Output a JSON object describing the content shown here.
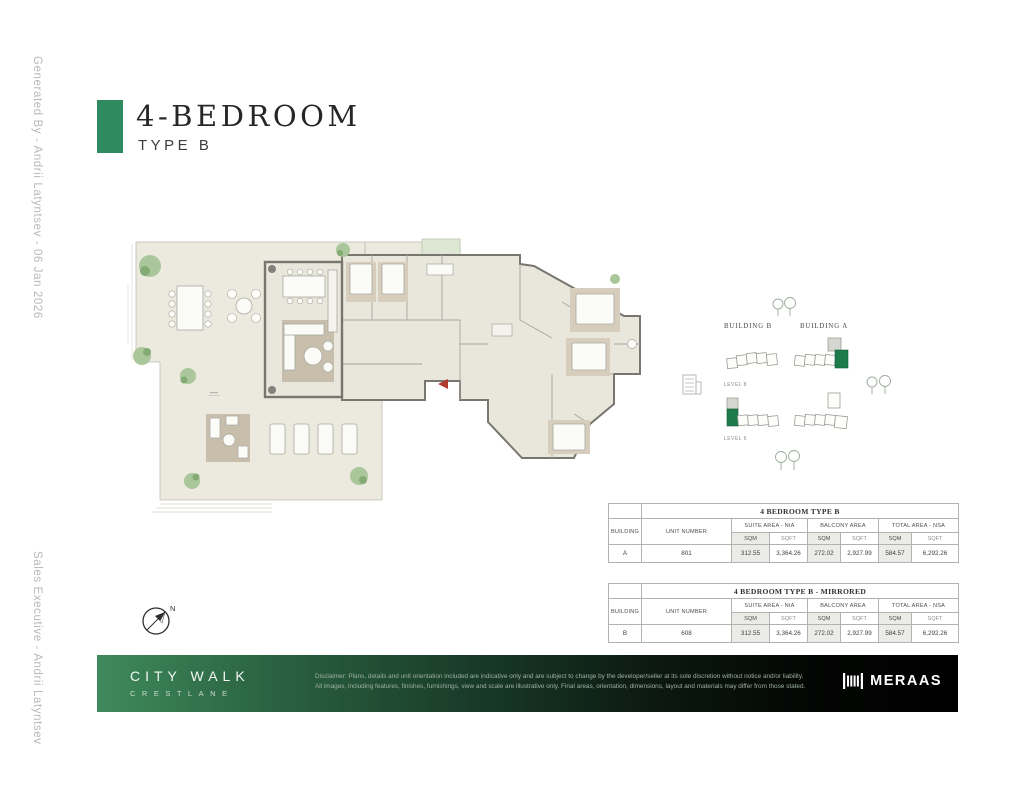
{
  "sidebar": {
    "generated_by": "Generated By - Andrii Latyntsev - 06 Jan 2026",
    "sales_executive": "Sales Executive - Andrii Latyntsev"
  },
  "header": {
    "title": "4-BEDROOM",
    "subtitle": "TYPE B",
    "accent_color": "#2f8a60"
  },
  "keyplan": {
    "building_b_label": "BUILDING B",
    "building_a_label": "BUILDING A",
    "level_top_label": "LEVEL 8",
    "level_bottom_label": "LEVEL 6",
    "highlight_color": "#1d7a4b"
  },
  "compass": {
    "north_label": "N"
  },
  "tables": [
    {
      "title": "4 BEDROOM TYPE B",
      "building_header": "BUILDING",
      "unit_header": "UNIT NUMBER",
      "group_headers": [
        "SUITE AREA - NIA",
        "BALCONY AREA",
        "TOTAL AREA - NSA"
      ],
      "unit_headers": [
        "SQM",
        "SQFT",
        "SQM",
        "SQFT",
        "SQM",
        "SQFT"
      ],
      "row": {
        "building": "A",
        "unit_number": "801",
        "values": [
          "312.55",
          "3,364.26",
          "272.02",
          "2,927.99",
          "584.57",
          "6,292.26"
        ]
      }
    },
    {
      "title": "4 BEDROOM TYPE B - MIRRORED",
      "building_header": "BUILDING",
      "unit_header": "UNIT NUMBER",
      "group_headers": [
        "SUITE AREA - NIA",
        "BALCONY AREA",
        "TOTAL AREA - NSA"
      ],
      "unit_headers": [
        "SQM",
        "SQFT",
        "SQM",
        "SQFT",
        "SQM",
        "SQFT"
      ],
      "row": {
        "building": "B",
        "unit_number": "608",
        "values": [
          "312.55",
          "3,364.26",
          "272.02",
          "2,927.99",
          "584.57",
          "6,292.26"
        ]
      }
    }
  ],
  "footer": {
    "brand_line1": "CITY WALK",
    "brand_line2": "CRESTLANE",
    "disclaimer_line1": "Disclaimer: Plans, details and unit orientation included are indicative only and are subject to change by the developer/seller at its sole discretion without notice and/or liability.",
    "disclaimer_line2": "All images, including features, finishes, furnishings, view and scale are illustrative only. Final areas, orientation, dimensions, layout and materials may differ from those stated.",
    "developer": "MERAAS",
    "gradient_start": "#3f8a5c",
    "gradient_end": "#000000"
  }
}
